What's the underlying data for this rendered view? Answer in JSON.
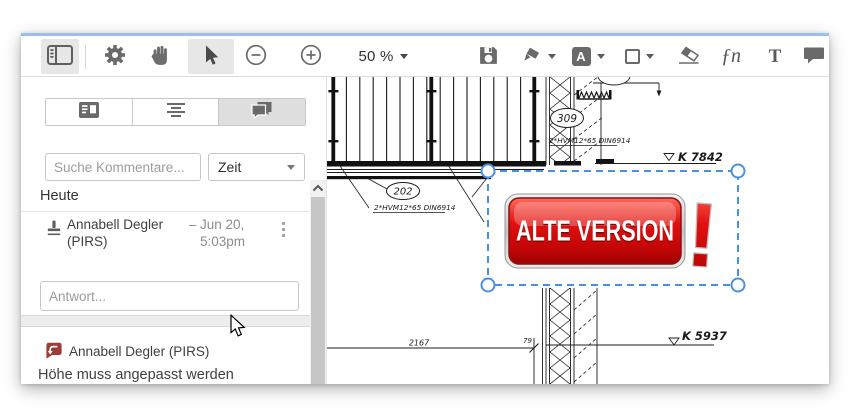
{
  "colors": {
    "accent_blue": "#4a90e2",
    "strip_blue": "#9cbfea",
    "icon_gray": "#6a6a6a",
    "stamp_red": "#e01010",
    "stamp_red_light": "#ff6a5a",
    "stamp_red_dark": "#9e0202",
    "comment_red": "#a03a36",
    "active_tool_bg": "#e7e7e7"
  },
  "toolbar": {
    "zoom_level": "50 %",
    "font_button_label": "A",
    "signature_glyph": "ƒn",
    "text_button_label": "T"
  },
  "sidebar": {
    "search_placeholder": "Suche Kommentare...",
    "sort_value": "Zeit",
    "section_header": "Heute",
    "comment_thread": {
      "author": "Annabell Degler (PIRS)",
      "dash": "–",
      "date_line1": "Jun 20,",
      "date_line2": "5:03pm",
      "reply_placeholder": "Antwort..."
    },
    "comment_preview": {
      "author": "Annabell Degler (PIRS)",
      "text": "Höhe muss angepasst werden"
    }
  },
  "document": {
    "stamp_text": "ALTE VERSION",
    "stamp_exclamation": "!",
    "labels": {
      "detail_upper": "309",
      "detail_lower": "202",
      "bolt_spec": "2*HVM12*65 DIN6914",
      "level_upper": "K 7842",
      "level_lower": "K 5937",
      "dim_total": "2167",
      "dim_small": "79"
    }
  }
}
